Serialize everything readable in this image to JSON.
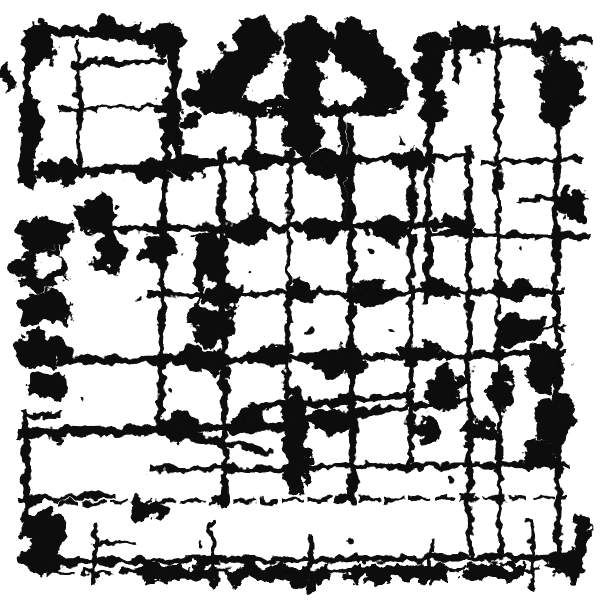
{
  "meta": {
    "title": "Abstract black and white grunge ink texture",
    "style": "monochrome distressed overlay",
    "alt_text": "Abstract grunge pattern of black ink blots, rough brush strokes, scratched grid lines and distressed borders on a white background"
  },
  "canvas": {
    "width": 600,
    "height": 600,
    "background": "#ffffff",
    "ink": "#0d0d0d"
  },
  "texture": {
    "noise_frequency": 0.062,
    "blob_displacement": 26,
    "stroke_displacement": 13
  },
  "blobs": [
    {
      "kind": "e",
      "cx": 255,
      "cy": 45,
      "rx": 22,
      "ry": 28
    },
    {
      "kind": "e",
      "cx": 305,
      "cy": 42,
      "rx": 26,
      "ry": 26
    },
    {
      "kind": "e",
      "cx": 352,
      "cy": 45,
      "rx": 22,
      "ry": 28
    },
    {
      "kind": "e",
      "cx": 232,
      "cy": 75,
      "rx": 18,
      "ry": 30
    },
    {
      "kind": "e",
      "cx": 375,
      "cy": 75,
      "rx": 18,
      "ry": 30
    },
    {
      "kind": "e",
      "cx": 210,
      "cy": 92,
      "rx": 14,
      "ry": 22
    },
    {
      "kind": "e",
      "cx": 395,
      "cy": 92,
      "rx": 14,
      "ry": 22
    },
    {
      "kind": "e",
      "cx": 303,
      "cy": 85,
      "rx": 20,
      "ry": 30
    },
    {
      "kind": "e",
      "cx": 272,
      "cy": 82,
      "rx": 12,
      "ry": 20,
      "fill": "bg"
    },
    {
      "kind": "e",
      "cx": 337,
      "cy": 82,
      "rx": 12,
      "ry": 20,
      "fill": "bg"
    },
    {
      "kind": "e",
      "cx": 303,
      "cy": 130,
      "rx": 20,
      "ry": 28
    },
    {
      "kind": "r",
      "x": 210,
      "y": 100,
      "w": 182,
      "h": 14
    },
    {
      "kind": "e",
      "cx": 40,
      "cy": 45,
      "rx": 16,
      "ry": 20
    },
    {
      "kind": "e",
      "cx": 165,
      "cy": 40,
      "rx": 18,
      "ry": 16
    },
    {
      "kind": "e",
      "cx": 110,
      "cy": 28,
      "rx": 26,
      "ry": 10
    },
    {
      "kind": "e",
      "cx": 30,
      "cy": 130,
      "rx": 10,
      "ry": 30
    },
    {
      "kind": "e",
      "cx": 170,
      "cy": 120,
      "rx": 10,
      "ry": 28
    },
    {
      "kind": "e",
      "cx": 60,
      "cy": 170,
      "rx": 26,
      "ry": 12
    },
    {
      "kind": "e",
      "cx": 150,
      "cy": 172,
      "rx": 20,
      "ry": 10
    },
    {
      "kind": "e",
      "cx": 430,
      "cy": 60,
      "rx": 16,
      "ry": 30
    },
    {
      "kind": "e",
      "cx": 470,
      "cy": 38,
      "rx": 26,
      "ry": 12
    },
    {
      "kind": "e",
      "cx": 560,
      "cy": 92,
      "rx": 22,
      "ry": 34
    },
    {
      "kind": "e",
      "cx": 545,
      "cy": 45,
      "rx": 15,
      "ry": 18
    },
    {
      "kind": "e",
      "cx": 570,
      "cy": 75,
      "rx": 14,
      "ry": 22
    },
    {
      "kind": "e",
      "cx": 572,
      "cy": 205,
      "rx": 14,
      "ry": 18
    },
    {
      "kind": "e",
      "cx": 432,
      "cy": 105,
      "rx": 14,
      "ry": 22
    },
    {
      "kind": "e",
      "cx": 45,
      "cy": 235,
      "rx": 28,
      "ry": 18
    },
    {
      "kind": "e",
      "cx": 40,
      "cy": 270,
      "rx": 26,
      "ry": 20
    },
    {
      "kind": "e",
      "cx": 45,
      "cy": 310,
      "rx": 28,
      "ry": 20
    },
    {
      "kind": "e",
      "cx": 42,
      "cy": 350,
      "rx": 26,
      "ry": 18
    },
    {
      "kind": "e",
      "cx": 50,
      "cy": 385,
      "rx": 22,
      "ry": 14
    },
    {
      "kind": "e",
      "cx": 48,
      "cy": 265,
      "rx": 12,
      "ry": 9,
      "fill": "bg"
    },
    {
      "kind": "e",
      "cx": 50,
      "cy": 330,
      "rx": 12,
      "ry": 10,
      "fill": "bg"
    },
    {
      "kind": "e",
      "cx": 45,
      "cy": 370,
      "rx": 10,
      "ry": 8,
      "fill": "bg"
    },
    {
      "kind": "e",
      "cx": 95,
      "cy": 215,
      "rx": 20,
      "ry": 18
    },
    {
      "kind": "e",
      "cx": 110,
      "cy": 250,
      "rx": 14,
      "ry": 25
    },
    {
      "kind": "r",
      "x": 196,
      "y": 232,
      "w": 30,
      "h": 70
    },
    {
      "kind": "e",
      "cx": 210,
      "cy": 320,
      "rx": 20,
      "ry": 25
    },
    {
      "kind": "e",
      "cx": 215,
      "cy": 295,
      "rx": 14,
      "ry": 16,
      "fill": "bg"
    },
    {
      "kind": "e",
      "cx": 158,
      "cy": 250,
      "rx": 18,
      "ry": 14
    },
    {
      "kind": "e",
      "cx": 190,
      "cy": 165,
      "rx": 22,
      "ry": 12
    },
    {
      "kind": "e",
      "cx": 260,
      "cy": 160,
      "rx": 18,
      "ry": 10
    },
    {
      "kind": "e",
      "cx": 330,
      "cy": 165,
      "rx": 25,
      "ry": 14
    },
    {
      "kind": "e",
      "cx": 410,
      "cy": 160,
      "rx": 20,
      "ry": 12
    },
    {
      "kind": "e",
      "cx": 250,
      "cy": 230,
      "rx": 22,
      "ry": 14
    },
    {
      "kind": "e",
      "cx": 320,
      "cy": 228,
      "rx": 20,
      "ry": 12
    },
    {
      "kind": "e",
      "cx": 390,
      "cy": 230,
      "rx": 22,
      "ry": 12
    },
    {
      "kind": "e",
      "cx": 460,
      "cy": 225,
      "rx": 18,
      "ry": 12
    },
    {
      "kind": "e",
      "cx": 225,
      "cy": 295,
      "rx": 20,
      "ry": 12
    },
    {
      "kind": "e",
      "cx": 300,
      "cy": 290,
      "rx": 16,
      "ry": 10
    },
    {
      "kind": "e",
      "cx": 370,
      "cy": 295,
      "rx": 20,
      "ry": 14
    },
    {
      "kind": "e",
      "cx": 440,
      "cy": 290,
      "rx": 16,
      "ry": 10
    },
    {
      "kind": "e",
      "cx": 200,
      "cy": 360,
      "rx": 22,
      "ry": 14
    },
    {
      "kind": "e",
      "cx": 270,
      "cy": 355,
      "rx": 18,
      "ry": 10
    },
    {
      "kind": "e",
      "cx": 340,
      "cy": 360,
      "rx": 26,
      "ry": 16
    },
    {
      "kind": "e",
      "cx": 420,
      "cy": 355,
      "rx": 18,
      "ry": 12
    },
    {
      "kind": "e",
      "cx": 180,
      "cy": 425,
      "rx": 20,
      "ry": 14
    },
    {
      "kind": "e",
      "cx": 250,
      "cy": 420,
      "rx": 16,
      "ry": 10
    },
    {
      "kind": "e",
      "cx": 330,
      "cy": 420,
      "rx": 20,
      "ry": 12
    },
    {
      "kind": "r",
      "x": 283,
      "y": 410,
      "w": 24,
      "h": 85
    },
    {
      "kind": "e",
      "cx": 295,
      "cy": 403,
      "rx": 10,
      "ry": 18
    },
    {
      "kind": "e",
      "cx": 520,
      "cy": 330,
      "rx": 25,
      "ry": 16
    },
    {
      "kind": "e",
      "cx": 545,
      "cy": 370,
      "rx": 20,
      "ry": 25
    },
    {
      "kind": "e",
      "cx": 555,
      "cy": 420,
      "rx": 18,
      "ry": 25
    },
    {
      "kind": "e",
      "cx": 540,
      "cy": 455,
      "rx": 16,
      "ry": 14
    },
    {
      "kind": "e",
      "cx": 500,
      "cy": 390,
      "rx": 14,
      "ry": 20
    },
    {
      "kind": "e",
      "cx": 480,
      "cy": 430,
      "rx": 16,
      "ry": 12
    },
    {
      "kind": "e",
      "cx": 445,
      "cy": 390,
      "rx": 18,
      "ry": 22
    },
    {
      "kind": "e",
      "cx": 430,
      "cy": 430,
      "rx": 14,
      "ry": 12
    },
    {
      "kind": "e",
      "cx": 520,
      "cy": 292,
      "rx": 30,
      "ry": 9
    },
    {
      "kind": "e",
      "cx": 45,
      "cy": 530,
      "rx": 22,
      "ry": 18
    },
    {
      "kind": "e",
      "cx": 40,
      "cy": 560,
      "rx": 20,
      "ry": 16
    },
    {
      "kind": "e",
      "cx": 150,
      "cy": 510,
      "rx": 18,
      "ry": 10
    },
    {
      "kind": "r",
      "x": 140,
      "y": 565,
      "w": 75,
      "h": 16
    },
    {
      "kind": "r",
      "x": 230,
      "y": 567,
      "w": 95,
      "h": 14
    },
    {
      "kind": "r",
      "x": 345,
      "y": 566,
      "w": 100,
      "h": 15
    },
    {
      "kind": "r",
      "x": 465,
      "y": 564,
      "w": 60,
      "h": 14
    },
    {
      "kind": "e",
      "cx": 580,
      "cy": 540,
      "rx": 10,
      "ry": 25
    },
    {
      "kind": "e",
      "cx": 565,
      "cy": 565,
      "rx": 18,
      "ry": 12
    },
    {
      "kind": "e",
      "cx": 198,
      "cy": 95,
      "rx": 14,
      "ry": 10
    },
    {
      "kind": "e",
      "cx": 190,
      "cy": 120,
      "rx": 10,
      "ry": 8
    },
    {
      "kind": "e",
      "cx": 8,
      "cy": 80,
      "rx": 6,
      "ry": 14
    }
  ],
  "strokes": [
    {
      "x1": 35,
      "y1": 30,
      "x2": 175,
      "y2": 38,
      "w": 10
    },
    {
      "x1": 30,
      "y1": 34,
      "x2": 24,
      "y2": 178,
      "w": 9
    },
    {
      "x1": 173,
      "y1": 36,
      "x2": 178,
      "y2": 170,
      "w": 8
    },
    {
      "x1": 30,
      "y1": 172,
      "x2": 175,
      "y2": 167,
      "w": 9
    },
    {
      "x1": 75,
      "y1": 64,
      "x2": 165,
      "y2": 61,
      "w": 6
    },
    {
      "x1": 78,
      "y1": 42,
      "x2": 80,
      "y2": 168,
      "w": 5
    },
    {
      "x1": 60,
      "y1": 110,
      "x2": 170,
      "y2": 107,
      "w": 4
    },
    {
      "x1": 428,
      "y1": 47,
      "x2": 586,
      "y2": 40,
      "w": 8
    },
    {
      "x1": 431,
      "y1": 42,
      "x2": 427,
      "y2": 300,
      "w": 7
    },
    {
      "x1": 497,
      "y1": 28,
      "x2": 500,
      "y2": 555,
      "w": 5
    },
    {
      "x1": 556,
      "y1": 62,
      "x2": 558,
      "y2": 558,
      "w": 7
    },
    {
      "x1": 520,
      "y1": 200,
      "x2": 586,
      "y2": 197,
      "w": 5
    },
    {
      "x1": 430,
      "y1": 233,
      "x2": 586,
      "y2": 237,
      "w": 6
    },
    {
      "x1": 483,
      "y1": 162,
      "x2": 580,
      "y2": 159,
      "w": 5
    },
    {
      "x1": 28,
      "y1": 60,
      "x2": 30,
      "y2": 186,
      "w": 8
    },
    {
      "x1": 25,
      "y1": 410,
      "x2": 27,
      "y2": 520,
      "w": 7
    },
    {
      "x1": 26,
      "y1": 418,
      "x2": 58,
      "y2": 414,
      "w": 6
    },
    {
      "x1": 20,
      "y1": 500,
      "x2": 115,
      "y2": 495,
      "w": 5
    },
    {
      "x1": 165,
      "y1": 140,
      "x2": 160,
      "y2": 432,
      "w": 6
    },
    {
      "x1": 222,
      "y1": 150,
      "x2": 225,
      "y2": 502,
      "w": 7
    },
    {
      "x1": 290,
      "y1": 142,
      "x2": 287,
      "y2": 405,
      "w": 5
    },
    {
      "x1": 350,
      "y1": 128,
      "x2": 353,
      "y2": 500,
      "w": 8
    },
    {
      "x1": 412,
      "y1": 150,
      "x2": 410,
      "y2": 468,
      "w": 6
    },
    {
      "x1": 468,
      "y1": 148,
      "x2": 470,
      "y2": 556,
      "w": 6
    },
    {
      "x1": 150,
      "y1": 163,
      "x2": 470,
      "y2": 157,
      "w": 6
    },
    {
      "x1": 90,
      "y1": 230,
      "x2": 462,
      "y2": 224,
      "w": 7
    },
    {
      "x1": 150,
      "y1": 295,
      "x2": 560,
      "y2": 291,
      "w": 6
    },
    {
      "x1": 60,
      "y1": 361,
      "x2": 562,
      "y2": 354,
      "w": 8
    },
    {
      "x1": 20,
      "y1": 433,
      "x2": 300,
      "y2": 427,
      "w": 10
    },
    {
      "x1": 300,
      "y1": 420,
      "x2": 470,
      "y2": 400,
      "w": 6
    },
    {
      "x1": 150,
      "y1": 470,
      "x2": 562,
      "y2": 464,
      "w": 6
    },
    {
      "x1": 60,
      "y1": 503,
      "x2": 566,
      "y2": 497,
      "w": 4,
      "dash": "16,9"
    },
    {
      "x1": 40,
      "y1": 562,
      "x2": 572,
      "y2": 557,
      "w": 6
    },
    {
      "x1": 46,
      "y1": 573,
      "x2": 560,
      "y2": 568,
      "w": 4,
      "dash": "26,13"
    },
    {
      "x1": 250,
      "y1": 408,
      "x2": 412,
      "y2": 395,
      "w": 7
    },
    {
      "x1": 150,
      "y1": 428,
      "x2": 270,
      "y2": 452,
      "w": 6
    },
    {
      "x1": 536,
      "y1": 330,
      "x2": 564,
      "y2": 327,
      "w": 4
    },
    {
      "x1": 212,
      "y1": 525,
      "x2": 214,
      "y2": 586,
      "w": 5
    },
    {
      "x1": 310,
      "y1": 535,
      "x2": 312,
      "y2": 590,
      "w": 5
    },
    {
      "x1": 432,
      "y1": 540,
      "x2": 430,
      "y2": 585,
      "w": 4
    },
    {
      "x1": 530,
      "y1": 520,
      "x2": 532,
      "y2": 585,
      "w": 5
    },
    {
      "x1": 95,
      "y1": 525,
      "x2": 93,
      "y2": 585,
      "w": 5
    },
    {
      "x1": 93,
      "y1": 545,
      "x2": 132,
      "y2": 541,
      "w": 4
    },
    {
      "x1": 253,
      "y1": 118,
      "x2": 255,
      "y2": 230,
      "w": 5
    },
    {
      "x1": 342,
      "y1": 114,
      "x2": 344,
      "y2": 230,
      "w": 6
    },
    {
      "x1": 210,
      "y1": 108,
      "x2": 262,
      "y2": 112,
      "w": 5
    },
    {
      "x1": 300,
      "y1": 108,
      "x2": 392,
      "y2": 112,
      "w": 6
    },
    {
      "x1": 457,
      "y1": 24,
      "x2": 455,
      "y2": 82,
      "w": 6
    }
  ],
  "specks": [
    {
      "cx": 120,
      "cy": 205,
      "r": 3
    },
    {
      "cx": 140,
      "cy": 300,
      "r": 3
    },
    {
      "cx": 250,
      "cy": 270,
      "r": 2
    },
    {
      "cx": 370,
      "cy": 250,
      "r": 3
    },
    {
      "cx": 430,
      "cy": 210,
      "r": 2
    },
    {
      "cx": 310,
      "cy": 330,
      "r": 3
    },
    {
      "cx": 170,
      "cy": 390,
      "r": 2
    },
    {
      "cx": 390,
      "cy": 330,
      "r": 2
    },
    {
      "cx": 450,
      "cy": 480,
      "r": 3
    },
    {
      "cx": 350,
      "cy": 540,
      "r": 2
    },
    {
      "cx": 200,
      "cy": 545,
      "r": 3
    },
    {
      "cx": 520,
      "cy": 250,
      "r": 2
    },
    {
      "cx": 60,
      "cy": 440,
      "r": 3
    },
    {
      "cx": 480,
      "cy": 60,
      "r": 2
    },
    {
      "cx": 400,
      "cy": 140,
      "r": 3
    },
    {
      "cx": 80,
      "cy": 400,
      "r": 2
    }
  ]
}
